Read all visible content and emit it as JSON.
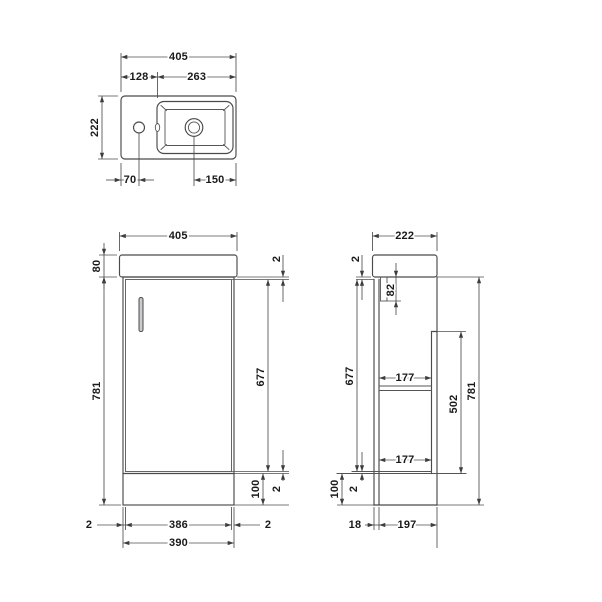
{
  "drawing": {
    "title": "Vanity basin unit technical drawing",
    "plan": {
      "overall_width": "405",
      "deck_width": "128",
      "bowl_width": "263",
      "overall_depth": "222",
      "tap_hole_offset": "70",
      "waste_offset": "150"
    },
    "front": {
      "overall_width": "405",
      "basin_height": "80",
      "cabinet_height": "781",
      "top_gap": "2",
      "door_height": "677",
      "bottom_gap": "2",
      "plinth_height": "100",
      "gap_left": "2",
      "door_width": "386",
      "gap_right": "2",
      "cabinet_width": "390"
    },
    "side": {
      "overall_depth": "222",
      "top_gap": "2",
      "door_height": "677",
      "basin_recess_depth": "82",
      "shelf_depth_upper": "177",
      "shelf_depth_lower": "177",
      "back_panel_height": "502",
      "cabinet_height": "781",
      "plinth_height": "100",
      "bottom_gap": "2",
      "door_thickness": "18",
      "carcass_depth": "197"
    }
  }
}
